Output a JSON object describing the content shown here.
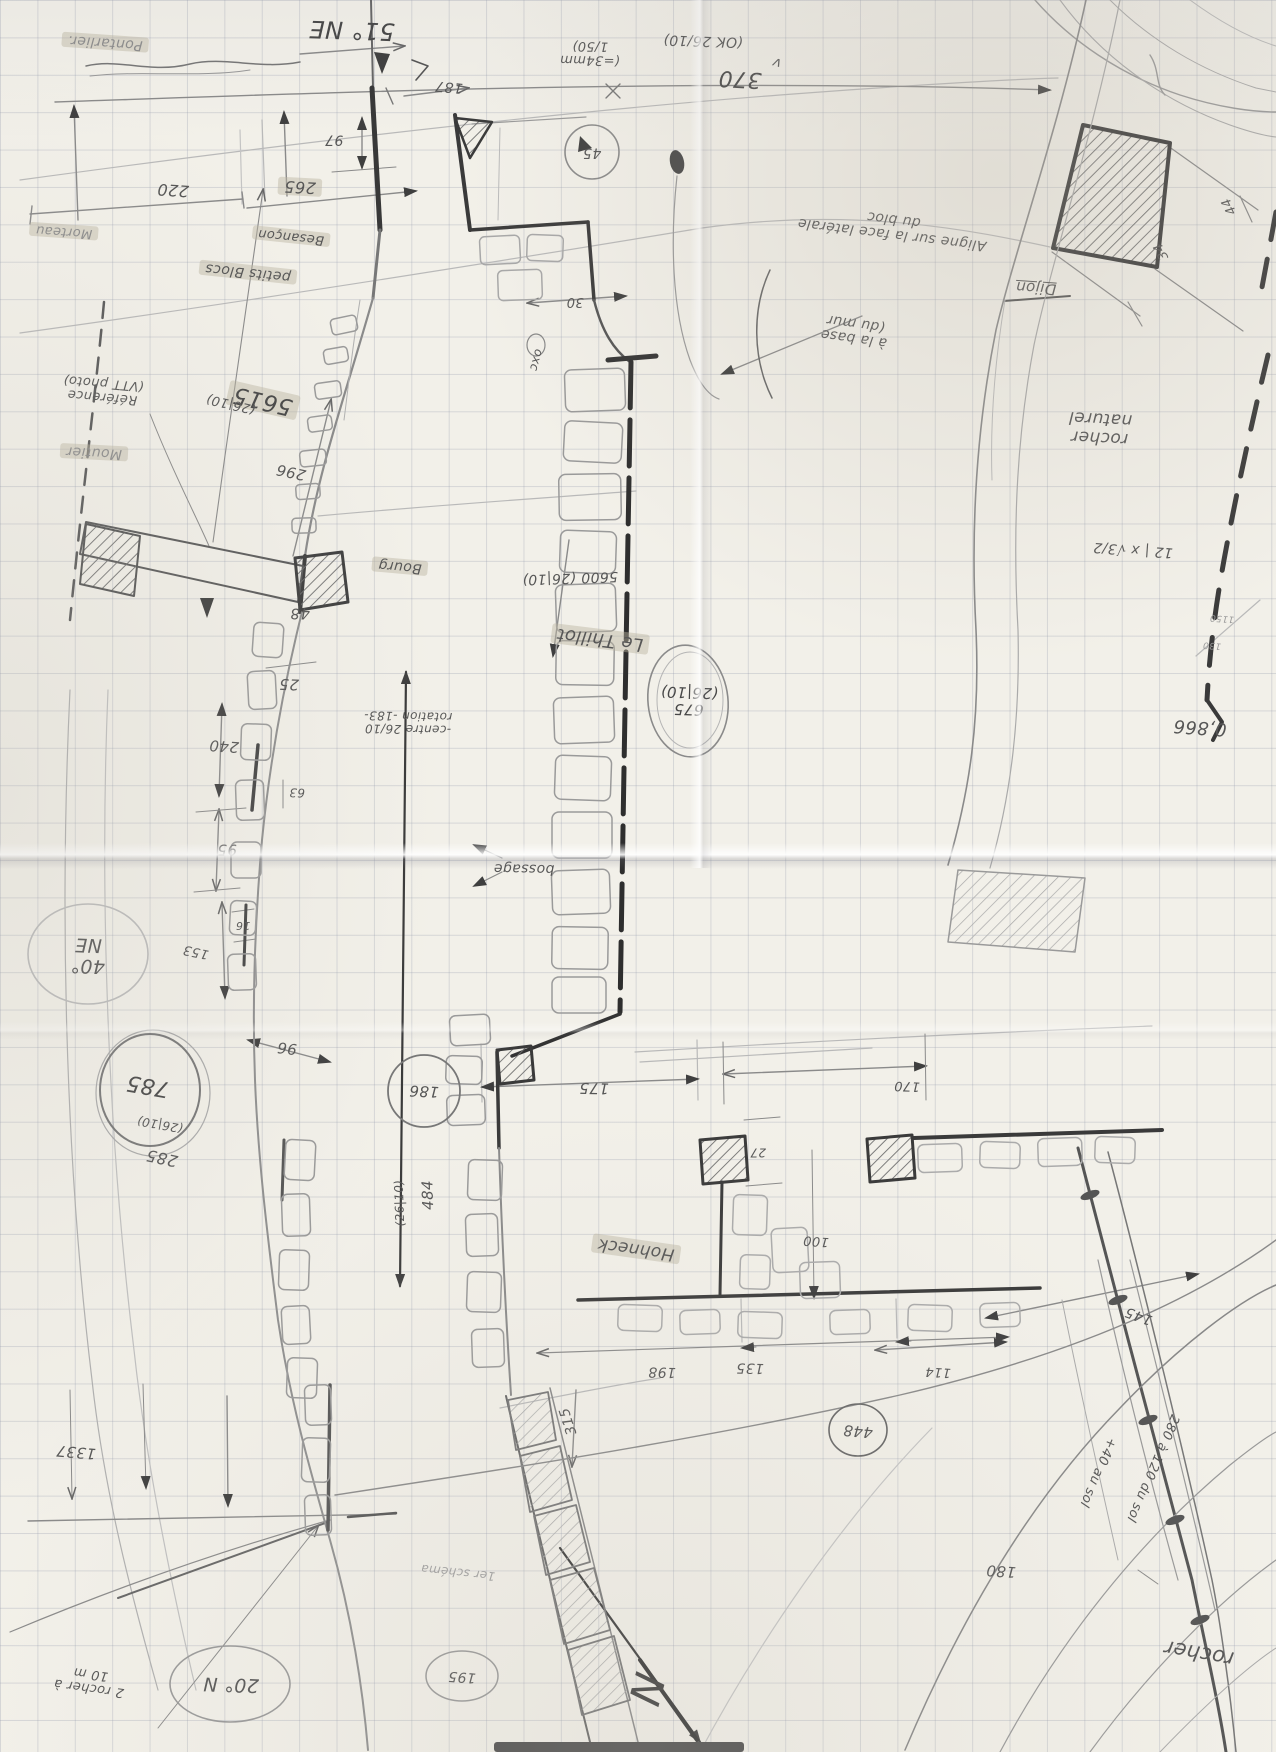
{
  "palette": {
    "paper": "#f2f0e9",
    "grid": "#949aac",
    "pencil": "#8a8a8a",
    "dark": "#3a3a3a",
    "highlight": "#bab4a0"
  },
  "labels": [
    {
      "id": "pontarlier",
      "text": "Pontarlier.",
      "x": 105,
      "y": 42,
      "rot": 184,
      "size": 14,
      "color": "#8d8d8d",
      "cls": "hl"
    },
    {
      "id": "bearing-51-ne",
      "text": "51° NE",
      "x": 352,
      "y": 30,
      "rot": 182,
      "size": 24,
      "color": "#474747"
    },
    {
      "id": "dim-187",
      "text": "187",
      "x": 449,
      "y": 86,
      "rot": 185,
      "size": 14
    },
    {
      "id": "dim-97",
      "text": "97",
      "x": 334,
      "y": 139,
      "rot": 180,
      "size": 14
    },
    {
      "id": "dim-265",
      "text": "265",
      "x": 300,
      "y": 187,
      "rot": 183,
      "size": 16,
      "cls": "hl"
    },
    {
      "id": "dim-220",
      "text": "220",
      "x": 173,
      "y": 190,
      "rot": 184,
      "size": 16
    },
    {
      "id": "morteau",
      "text": "Morteau",
      "x": 64,
      "y": 231,
      "rot": 184,
      "size": 13,
      "color": "#8d8d8d",
      "cls": "hl"
    },
    {
      "id": "scale-note",
      "text": "(=34mm\n1/50)",
      "x": 590,
      "y": 52,
      "rot": 181,
      "size": 13
    },
    {
      "id": "ok-26-10",
      "text": "(OK 26/10)",
      "x": 703,
      "y": 40,
      "rot": 182,
      "size": 14
    },
    {
      "id": "dim-370",
      "text": "370",
      "x": 740,
      "y": 78,
      "rot": 183,
      "size": 22,
      "color": "#474747"
    },
    {
      "id": "check-mark",
      "text": "v",
      "x": 777,
      "y": 62,
      "rot": 195,
      "size": 14
    },
    {
      "id": "aligne-note",
      "text": "Aligne sur la face latérale\ndu bloc",
      "x": 893,
      "y": 226,
      "rot": 187,
      "size": 14
    },
    {
      "id": "dijon",
      "text": "Dijon",
      "x": 1036,
      "y": 288,
      "rot": 184,
      "size": 15,
      "cls": "ul"
    },
    {
      "id": "dim-34",
      "text": "34",
      "x": 1162,
      "y": 251,
      "rot": 243,
      "size": 13
    },
    {
      "id": "dim-44",
      "text": "44",
      "x": 1230,
      "y": 206,
      "rot": 243,
      "size": 13
    },
    {
      "id": "dim-45",
      "text": "45",
      "x": 592,
      "y": 152,
      "rot": 180,
      "size": 14
    },
    {
      "id": "dim-30",
      "text": "30",
      "x": 575,
      "y": 301,
      "rot": 180,
      "size": 13
    },
    {
      "id": "besancon",
      "text": "Besançon",
      "x": 291,
      "y": 236,
      "rot": 186,
      "size": 13,
      "cls": "hl"
    },
    {
      "id": "petits-blocs",
      "text": "petits Blocs",
      "x": 248,
      "y": 272,
      "rot": 186,
      "size": 14,
      "cls": "hl"
    },
    {
      "id": "oxc",
      "text": "oxc",
      "x": 536,
      "y": 360,
      "rot": 105,
      "size": 12
    },
    {
      "id": "dim-5615",
      "text": "5615",
      "x": 263,
      "y": 400,
      "rot": 193,
      "size": 23,
      "color": "#474747",
      "cls": "hl"
    },
    {
      "id": "dim-5615-date",
      "text": "(26|10)",
      "x": 231,
      "y": 403,
      "rot": 193,
      "size": 13
    },
    {
      "id": "reference-note",
      "text": "Référence\n(VTT photo)",
      "x": 103,
      "y": 389,
      "rot": 185,
      "size": 13
    },
    {
      "id": "dim-296",
      "text": "296",
      "x": 291,
      "y": 472,
      "rot": 192,
      "size": 15
    },
    {
      "id": "moutier",
      "text": "Moutier",
      "x": 94,
      "y": 452,
      "rot": 183,
      "size": 14,
      "color": "#8d8d8d",
      "cls": "hl"
    },
    {
      "id": "dim-5600",
      "text": "5600 (26|10)",
      "x": 570,
      "y": 577,
      "rot": 178,
      "size": 14
    },
    {
      "id": "bourg",
      "text": "Bourg",
      "x": 400,
      "y": 566,
      "rot": 185,
      "size": 14,
      "cls": "hl"
    },
    {
      "id": "dim-48",
      "text": "48",
      "x": 300,
      "y": 613,
      "rot": 180,
      "size": 15
    },
    {
      "id": "dim-25",
      "text": "25",
      "x": 289,
      "y": 684,
      "rot": 182,
      "size": 15
    },
    {
      "id": "centre-note",
      "text": "-centre 26/10\nrotation -183-",
      "x": 408,
      "y": 722,
      "rot": 181,
      "size": 12
    },
    {
      "id": "le-thillot",
      "text": "Le Thillot",
      "x": 600,
      "y": 639,
      "rot": 187,
      "size": 18,
      "cls": "hl"
    },
    {
      "id": "dim-675",
      "text": "675\n(26|10)",
      "x": 689,
      "y": 701,
      "rot": 182,
      "size": 15,
      "color": "#474747"
    },
    {
      "id": "rocher-naturel",
      "text": "rocher\nnaturel",
      "x": 1100,
      "y": 428,
      "rot": 183,
      "size": 17
    },
    {
      "id": "math-note",
      "text": "12 | x √3/2",
      "x": 1133,
      "y": 549,
      "rot": 184,
      "size": 14
    },
    {
      "id": "value-0866",
      "text": "0,866",
      "x": 1200,
      "y": 727,
      "rot": 184,
      "size": 18
    },
    {
      "id": "value-1150",
      "text": "1150",
      "x": 1222,
      "y": 617,
      "rot": 184,
      "size": 9,
      "color": "#9a9a9a"
    },
    {
      "id": "value-130",
      "text": "130",
      "x": 1212,
      "y": 644,
      "rot": 184,
      "size": 9,
      "color": "#9a9a9a"
    },
    {
      "id": "a-la-base",
      "text": "à la base\n(du mur",
      "x": 855,
      "y": 330,
      "rot": 188,
      "size": 14
    },
    {
      "id": "dim-240",
      "text": "240",
      "x": 224,
      "y": 746,
      "rot": 184,
      "size": 15
    },
    {
      "id": "dim-63",
      "text": "63",
      "x": 297,
      "y": 792,
      "rot": 182,
      "size": 12
    },
    {
      "id": "dim-95",
      "text": "95",
      "x": 227,
      "y": 849,
      "rot": 180,
      "size": 15
    },
    {
      "id": "dim-16",
      "text": "16",
      "x": 243,
      "y": 925,
      "rot": 180,
      "size": 11
    },
    {
      "id": "dim-153",
      "text": "153",
      "x": 196,
      "y": 951,
      "rot": 192,
      "size": 13
    },
    {
      "id": "dim-96",
      "text": "96",
      "x": 287,
      "y": 1048,
      "rot": 186,
      "size": 15
    },
    {
      "id": "bearing-40-ne",
      "text": "40°\nNE",
      "x": 88,
      "y": 955,
      "rot": 182,
      "size": 19
    },
    {
      "id": "dim-785",
      "text": "785",
      "x": 148,
      "y": 1085,
      "rot": 190,
      "size": 22,
      "color": "#474747"
    },
    {
      "id": "dim-785-date",
      "text": "(26|10)",
      "x": 160,
      "y": 1124,
      "rot": 190,
      "size": 12
    },
    {
      "id": "dim-285",
      "text": "285",
      "x": 162,
      "y": 1158,
      "rot": 192,
      "size": 16
    },
    {
      "id": "dim-186",
      "text": "186",
      "x": 424,
      "y": 1091,
      "rot": 183,
      "size": 15
    },
    {
      "id": "dim-175",
      "text": "175",
      "x": 594,
      "y": 1088,
      "rot": 181,
      "size": 15
    },
    {
      "id": "dim-484",
      "text": "484",
      "x": 428,
      "y": 1195,
      "rot": 268,
      "size": 15
    },
    {
      "id": "dim-484-date",
      "text": "(26|10)",
      "x": 400,
      "y": 1203,
      "rot": 268,
      "size": 12
    },
    {
      "id": "hohneck",
      "text": "Hohneck",
      "x": 636,
      "y": 1249,
      "rot": 188,
      "size": 17,
      "cls": "hl"
    },
    {
      "id": "dim-170",
      "text": "170",
      "x": 907,
      "y": 1085,
      "rot": 182,
      "size": 13
    },
    {
      "id": "dim-27",
      "text": "27",
      "x": 758,
      "y": 1152,
      "rot": 180,
      "size": 12
    },
    {
      "id": "dim-100",
      "text": "100",
      "x": 816,
      "y": 1240,
      "rot": 184,
      "size": 13
    },
    {
      "id": "dim-198",
      "text": "198",
      "x": 662,
      "y": 1371,
      "rot": 181,
      "size": 14
    },
    {
      "id": "dim-135",
      "text": "135",
      "x": 750,
      "y": 1367,
      "rot": 181,
      "size": 14
    },
    {
      "id": "dim-448",
      "text": "448",
      "x": 858,
      "y": 1431,
      "rot": 185,
      "size": 15
    },
    {
      "id": "dim-114",
      "text": "114",
      "x": 938,
      "y": 1371,
      "rot": 183,
      "size": 13
    },
    {
      "id": "dim-145",
      "text": "145",
      "x": 1139,
      "y": 1315,
      "rot": 200,
      "size": 14
    },
    {
      "id": "note-280",
      "text": "280 à 120 du sol",
      "x": 1152,
      "y": 1468,
      "rot": 113,
      "size": 13
    },
    {
      "id": "note-40-sol",
      "text": "+40 au sol",
      "x": 1097,
      "y": 1472,
      "rot": 113,
      "size": 13
    },
    {
      "id": "dim-180",
      "text": "180",
      "x": 1001,
      "y": 1571,
      "rot": 184,
      "size": 15
    },
    {
      "id": "rocher",
      "text": "rocher",
      "x": 1199,
      "y": 1653,
      "rot": 190,
      "size": 21
    },
    {
      "id": "dim-315",
      "text": "315",
      "x": 569,
      "y": 1421,
      "rot": 252,
      "size": 14
    },
    {
      "id": "dim-1337",
      "text": "1337",
      "x": 76,
      "y": 1452,
      "rot": 185,
      "size": 15
    },
    {
      "id": "bearing-20-n",
      "text": "20° N",
      "x": 231,
      "y": 1684,
      "rot": 182,
      "size": 19
    },
    {
      "id": "note-2-rocher",
      "text": "2 rocher à\n10 m",
      "x": 90,
      "y": 1680,
      "rot": 188,
      "size": 13
    },
    {
      "id": "dim-195",
      "text": "195",
      "x": 462,
      "y": 1676,
      "rot": 184,
      "size": 14
    },
    {
      "id": "schema-note",
      "text": "1er schéma",
      "x": 458,
      "y": 1572,
      "rot": 186,
      "size": 12,
      "color": "#a0a0a0"
    },
    {
      "id": "bossage",
      "text": "bossage",
      "x": 524,
      "y": 868,
      "rot": 181,
      "size": 14
    },
    {
      "id": "north-letter",
      "text": "N",
      "x": 646,
      "y": 1689,
      "rot": 105,
      "size": 42,
      "color": "#3d3d3d"
    }
  ]
}
